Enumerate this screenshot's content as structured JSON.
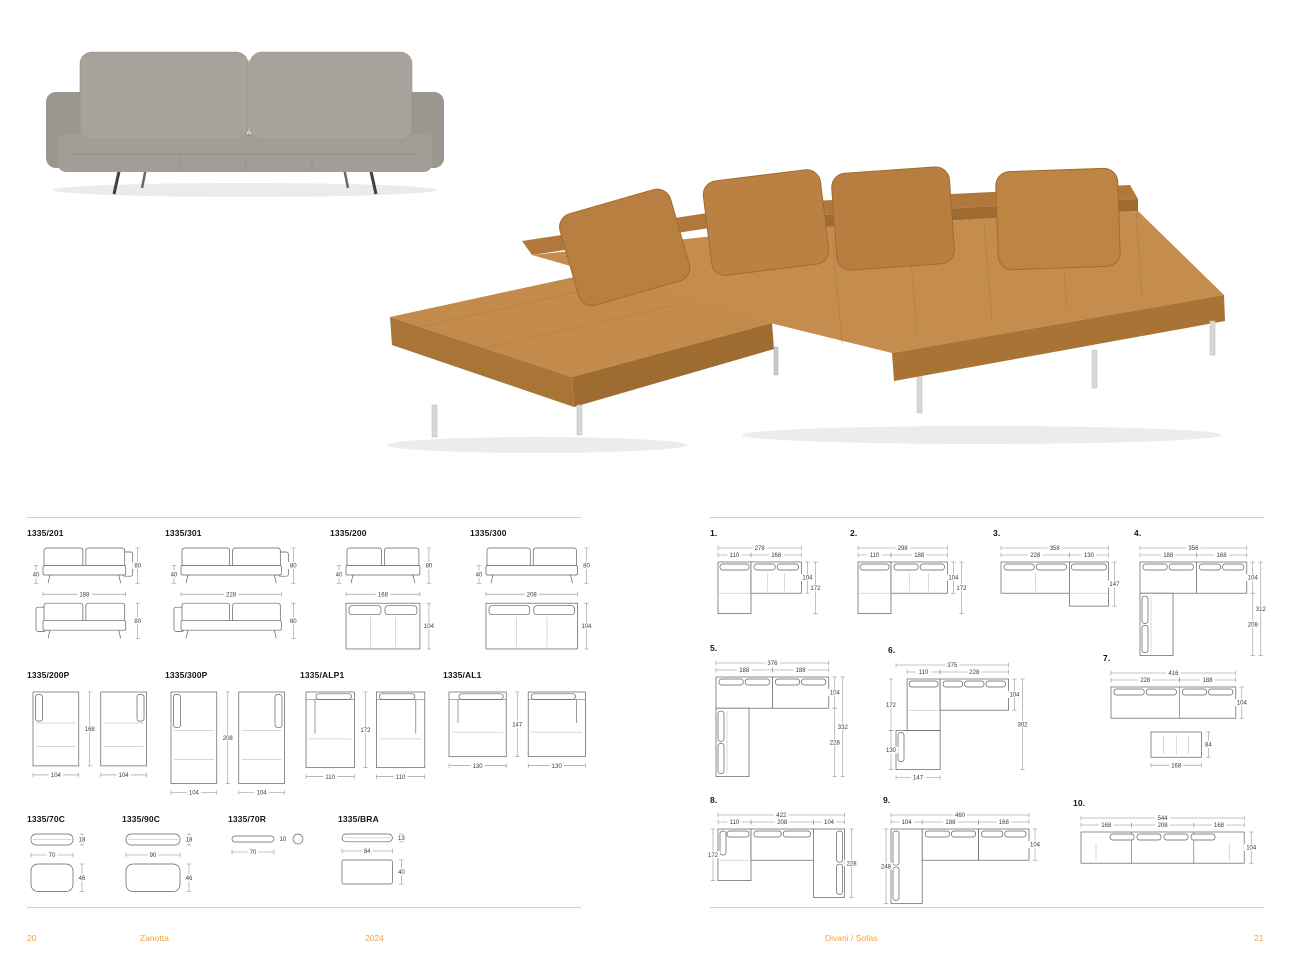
{
  "document": {
    "type": "furniture-catalog-spread",
    "model_family": "1335"
  },
  "colors": {
    "accent": "#efa340",
    "leather_tan": "#c48d4e",
    "leather_tan_dark": "#a87435",
    "fabric_gray": "#a5a19a",
    "drawing_line": "#5f5f5f",
    "dimension_line": "#8c8c8c"
  },
  "footer_left": {
    "page_number": "20",
    "brand": "Zanotta",
    "year": "2024"
  },
  "footer_right": {
    "section": "Divani / Sofas",
    "page_number": "21"
  },
  "models": [
    {
      "label": "1335/201",
      "dims": {
        "w": "188",
        "h": "80",
        "sh": "40",
        "h2": "80"
      }
    },
    {
      "label": "1335/301",
      "dims": {
        "w": "228",
        "h": "80",
        "sh": "40",
        "h2": "80"
      }
    },
    {
      "label": "1335/200",
      "dims": {
        "w": "168",
        "h": "80",
        "sh": "40",
        "d": "104"
      }
    },
    {
      "label": "1335/300",
      "dims": {
        "w": "208",
        "h": "80",
        "sh": "40",
        "d": "104"
      }
    },
    {
      "label": "1335/200P",
      "dims": {
        "w1": "104",
        "w2": "104",
        "d": "168"
      }
    },
    {
      "label": "1335/300P",
      "dims": {
        "w1": "104",
        "w2": "104",
        "d": "208"
      }
    },
    {
      "label": "1335/ALP1",
      "dims": {
        "w1": "110",
        "w2": "110",
        "d": "172"
      }
    },
    {
      "label": "1335/AL1",
      "dims": {
        "w1": "130",
        "w2": "130",
        "d": "147"
      }
    },
    {
      "label": "1335/70C",
      "dims": {
        "w": "70",
        "h": "18",
        "d": "46"
      }
    },
    {
      "label": "1335/90C",
      "dims": {
        "w": "90",
        "h": "18",
        "d": "46"
      }
    },
    {
      "label": "1335/70R",
      "dims": {
        "w": "70",
        "h": "10"
      }
    },
    {
      "label": "1335/BRA",
      "dims": {
        "w": "84",
        "h": "13",
        "d": "40"
      }
    }
  ],
  "configs": [
    {
      "num": "1.",
      "dims": {
        "total": "278",
        "a": "110",
        "b": "168",
        "d": "104",
        "e": "172"
      }
    },
    {
      "num": "2.",
      "dims": {
        "total": "298",
        "a": "110",
        "b": "188",
        "d": "104",
        "e": "172"
      }
    },
    {
      "num": "3.",
      "dims": {
        "total": "358",
        "a": "228",
        "b": "130",
        "e": "147"
      }
    },
    {
      "num": "4.",
      "dims": {
        "total": "356",
        "a": "188",
        "b": "168",
        "d": "104",
        "f": "208",
        "e": "312"
      }
    },
    {
      "num": "5.",
      "dims": {
        "total": "376",
        "a": "188",
        "b": "188",
        "d": "104",
        "f": "228",
        "e": "332"
      }
    },
    {
      "num": "6.",
      "dims": {
        "total": "375",
        "a": "110",
        "b": "228",
        "left": "172",
        "left2": "130",
        "bottom": "147",
        "d": "104",
        "e": "302"
      }
    },
    {
      "num": "7.",
      "dims": {
        "total": "416",
        "a": "228",
        "b": "188",
        "d": "104",
        "bench_w": "168",
        "bench_d": "84"
      }
    },
    {
      "num": "8.",
      "dims": {
        "total": "422",
        "a": "110",
        "b": "208",
        "c": "104",
        "left": "172",
        "right": "228"
      }
    },
    {
      "num": "9.",
      "dims": {
        "total": "460",
        "a": "104",
        "b": "188",
        "c": "168",
        "left": "248",
        "d": "104"
      }
    },
    {
      "num": "10.",
      "dims": {
        "total": "544",
        "a": "168",
        "b": "208",
        "c": "168",
        "d": "104"
      }
    }
  ]
}
